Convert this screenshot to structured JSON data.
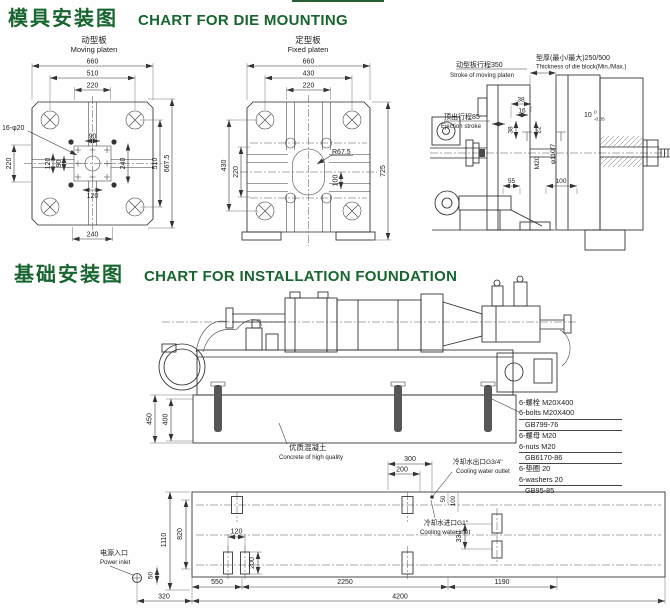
{
  "page": {
    "title_die_zh": "模具安装图",
    "title_die_en": "CHART FOR DIE MOUNTING",
    "title_foundation_zh": "基础安装图",
    "title_foundation_en": "CHART FOR INSTALLATION FOUNDATION",
    "accent_color": "#17652f"
  },
  "moving_platen": {
    "label_zh": "动型板",
    "label_en": "Moving platen",
    "hole_callout": "16-φ20",
    "dim_width": "660",
    "dim_510": "510",
    "dim_220_top": "220",
    "dim_220_left": "220",
    "dim_120_left": "120",
    "dim_90_left": "90",
    "dim_90_center": "90",
    "dim_120_bottom": "120",
    "dim_240_right": "240",
    "dim_510_right": "510",
    "dim_height": "667.5",
    "dim_240_bottom": "240"
  },
  "fixed_platen": {
    "label_zh": "定型板",
    "label_en": "Fixed platen",
    "dim_width": "660",
    "dim_430_top": "430",
    "dim_220_top": "220",
    "dim_430_left": "430",
    "dim_220_left": "220",
    "dim_height": "725",
    "radius_callout": "R67.5",
    "dim_100": "100"
  },
  "die_section": {
    "stroke_zh": "动型板行程350",
    "stroke_en": "Stroke of moving platen",
    "thickness_zh": "型厚(最小/最大)250/500",
    "thickness_en": "Thickness of die block(Min./Max.)",
    "ejection_zh": "顶出行程85",
    "ejection_en": "Ejection stroke",
    "dim_38a": "38",
    "dim_16": "16",
    "dim_38b": "38",
    "dim_22": "22",
    "dim_10": "10",
    "dim_10_tol_upper": "0",
    "dim_10_tol_lower": "-0.05",
    "dim_m20": "M20",
    "dim_dia110": "φ110f7",
    "dim_55": "55",
    "dim_100": "100"
  },
  "foundation_elevation": {
    "dim_450": "450",
    "dim_400": "400",
    "concrete_zh": "优质混凝土",
    "concrete_en": "Concrete of high quality"
  },
  "parts_list": {
    "bolt_zh": "6-螺栓 M20X400",
    "bolt_en": "6-bolts M20X400",
    "bolt_std": "GB799-76",
    "nut_zh": "6-螺母 M20",
    "nut_en": "6-nuts M20",
    "nut_std": "GB6170-86",
    "washer_zh": "6-垫圈 20",
    "washer_en": "6-washers 20",
    "washer_std": "GB95-85"
  },
  "foundation_plan": {
    "dim_300": "300",
    "dim_200_top": "200",
    "outlet_zh": "冷却水出口G3/4\"",
    "outlet_en": "Cooling water outlet",
    "inlet_zh": "冷却水进口G1\"",
    "inlet_en": "Cooling water inlet",
    "dim_50_outlet": "50",
    "dim_100_outlet": "100",
    "dim_330": "330",
    "dim_1110": "1110",
    "dim_820": "820",
    "dim_120": "120",
    "dim_200": "200",
    "power_zh": "电源入口",
    "power_en": "Power inlet",
    "dim_50": "50",
    "dim_320": "320",
    "dim_550": "550",
    "dim_2250": "2250",
    "dim_1190": "1190",
    "dim_4200": "4200"
  }
}
